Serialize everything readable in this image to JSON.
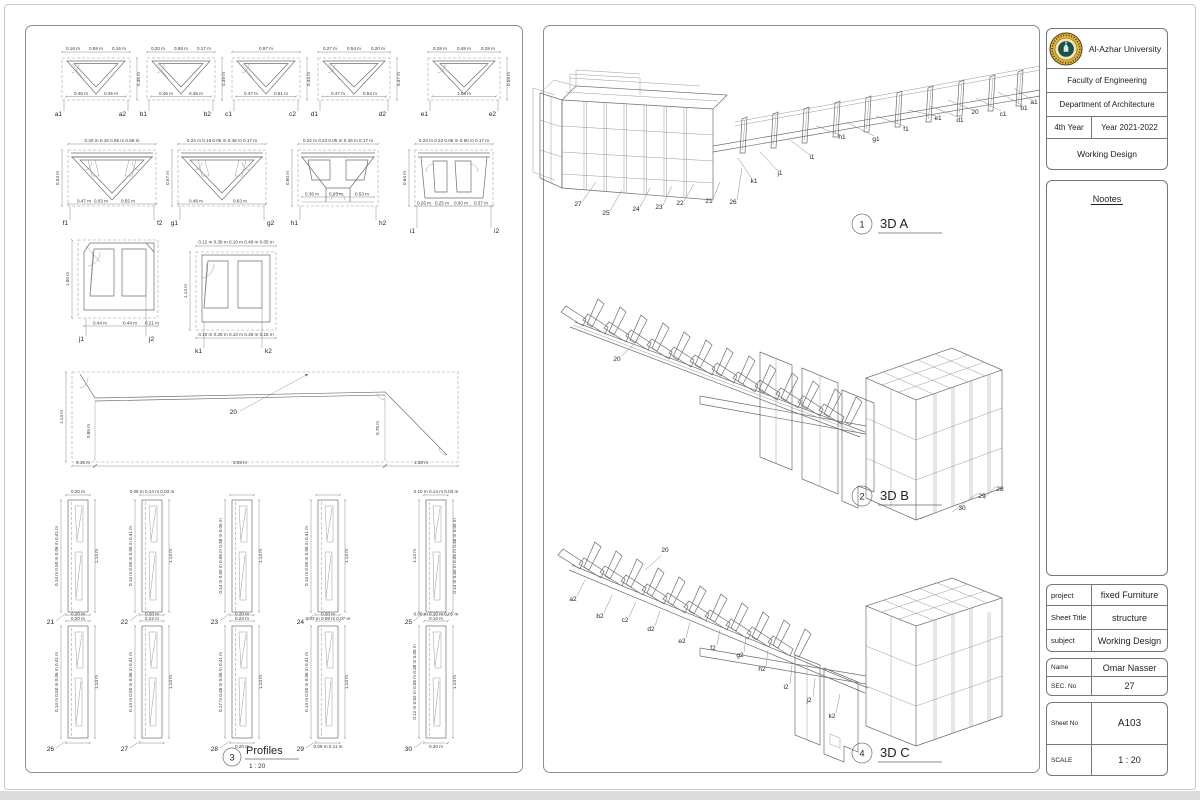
{
  "title_block": {
    "university": "Al-Azhar University",
    "faculty": "Faculty of Engineering",
    "department": "Department of Architecture",
    "year_label": "4th Year",
    "year_value": "Year 2021-2022",
    "design": "Working Design",
    "notes": "Nootes"
  },
  "info": {
    "project_label": "project",
    "project": "fixed Furniture",
    "sheet_title_label": "Sheet Title",
    "sheet_title": "structure",
    "subject_label": "subject",
    "subject": "Working Design",
    "name_label": "Name",
    "name": "Omar Nasser",
    "sec_label": "SEC. No",
    "sec": "27",
    "sheet_no_label": "Sheet No",
    "sheet_no": "A103",
    "scale_label": "SCALE",
    "scale": "1 : 20"
  },
  "views": {
    "a": {
      "num": "1",
      "title": "3D A",
      "labels": [
        "27",
        "25",
        "24",
        "23",
        "22",
        "21",
        "26",
        "k1",
        "j1",
        "i1",
        "h1",
        "g1",
        "f1",
        "e1",
        "d1",
        "20",
        "c1",
        "b1",
        "a1"
      ]
    },
    "b": {
      "num": "2",
      "title": "3D B",
      "labels": [
        "20",
        "30",
        "29",
        "28"
      ]
    },
    "c": {
      "num": "4",
      "title": "3D C",
      "labels": [
        "20",
        "a2",
        "b2",
        "c2",
        "d2",
        "e2",
        "f2",
        "g2",
        "h2",
        "i2",
        "j2",
        "k2"
      ]
    },
    "profiles": {
      "num": "3",
      "title": "Profiles",
      "scale": "1 : 20"
    }
  },
  "p": {
    "a": {
      "l": "a1",
      "r": "a2",
      "top": [
        "0.16 m",
        "0.58 m",
        "0.16 m"
      ],
      "bot": [
        "0.45 m",
        "0.45 m"
      ],
      "side": "0.35 m"
    },
    "b": {
      "l": "b1",
      "r": "b2",
      "top": [
        "0.20 m",
        "0.58 m",
        "0.17 m"
      ],
      "bot": [
        "0.46 m",
        "0.46 m"
      ],
      "side": "0.39 m"
    },
    "c": {
      "l": "c1",
      "r": "c2",
      "top": [
        "",
        "0.97 m",
        ""
      ],
      "bot": [
        "0.47 m",
        "0.51 m"
      ],
      "side": "0.43 m"
    },
    "d": {
      "l": "d1",
      "r": "d2",
      "top": [
        "0.27 m",
        "0.54 m",
        "0.20 m"
      ],
      "bot": [
        "0.47 m",
        "0.54 m"
      ],
      "side": "0.47 m"
    },
    "e": {
      "l": "e1",
      "r": "e2",
      "top": [
        "0.28 m",
        "0.48 m",
        "0.28 m"
      ],
      "bot": [
        "1.04 m",
        ""
      ],
      "side": "0.59 m"
    },
    "f": {
      "l": "f1",
      "r": "f2",
      "top": "0.20 m 0.16 0.05 m       0.66 m",
      "bot": [
        "0.47 m",
        "0.03 m",
        "0.55 m",
        ""
      ],
      "side": "0.54 m"
    },
    "g": {
      "l": "g1",
      "r": "g2",
      "top": "0.24 m 0.16 0.05 m   0.48 m   0.17 m",
      "bot": [
        "0.48 m",
        "0.63 m",
        "",
        ""
      ],
      "side": "0.57 m"
    },
    "h": {
      "l": "h1",
      "r": "h2",
      "top": "0.22 m 0.22 0.05 m   0.49 m   0.17 m",
      "bot": [
        "0.36 m",
        "0.23 m",
        "0.53 m",
        ""
      ],
      "side": "0.60 m"
    },
    "i": {
      "l": "i1",
      "r": "i2",
      "top": "0.23 m 0.22 0.06 m   0.50 m   0.17 m",
      "bot": [
        "0.26 m",
        "0.25 m",
        "0.30 m",
        "0.37 m"
      ],
      "side": "0.64 m"
    },
    "j": {
      "l": "j1",
      "r": "j2",
      "bot": [
        "0.44 m",
        "0.44 m",
        "0.21 m"
      ],
      "side": "1.00 m"
    },
    "k": {
      "l": "k1",
      "r": "k2",
      "top": "0.12 m  0.39 m  0.10 m  0.48 m  0.05 m",
      "bot": "0.10 m   0.25 m  0.10 m  0.48 m   0.15 m",
      "side": "1.14 m"
    },
    "p20": {
      "label": "20",
      "side": "1.14 m",
      "ha": "0.85 m",
      "hb": "0.78 m",
      "bot": [
        "0.18 m",
        "3.08 m",
        "1.38 m"
      ]
    },
    "slats": [
      {
        "n": "21",
        "top": "0.20 m",
        "left": "0.14 m  0.50 m  0.06 m  0.41 m",
        "right": "1.14 m",
        "bot": "0.20 m"
      },
      {
        "n": "22",
        "top": "0.05 m  0.14 m  0.03 m",
        "left": "0.14 m  0.50 m  0.06 m  0.41 m",
        "right": "1.14 m",
        "bot": "0.22 m"
      },
      {
        "n": "23",
        "top": "",
        "left": "0.14 m 0.50 m 0.06 m 0.38 m 0.05 m",
        "right": "1.14 m",
        "bot": "0.23 m"
      },
      {
        "n": "24",
        "top": "",
        "left": "0.14 m  0.50 m  0.06 m  0.41 m",
        "right": "1.14 m",
        "bot": "0.03 m 0.08 m 0.07 m"
      },
      {
        "n": "25",
        "top": "0.10 m  0.14 m  0.03 m",
        "left": "1.14 m",
        "right": "0.14 m 0.50 m 0.06 m 0.38 m 0.05 m",
        "bot": "0.10 m"
      },
      {
        "n": "26",
        "top": "0.20 m",
        "left": "0.14 m  0.50 m  0.06 m  0.41 m",
        "right": "1.14 m",
        "bot": ""
      },
      {
        "n": "27",
        "top": "0.20 m",
        "left": "0.14 m  0.50 m  0.06 m  0.41 m",
        "right": "1.14 m",
        "bot": ""
      },
      {
        "n": "28",
        "top": "0.20 m",
        "left": "0.17 m  0.46 m  0.06 m  0.41 m",
        "right": "1.14 m",
        "bot": "0.20 m"
      },
      {
        "n": "29",
        "top": "0.20 m",
        "left": "0.14 m  0.50 m  0.06 m  0.41 m",
        "right": "1.14 m",
        "bot": "0.09 m 0.11 m"
      },
      {
        "n": "30",
        "top": "0.06 m  0.10 m  0.05 m",
        "left": "0.12 m 0.52 m 0.06 m 0.38 m 0.05 m",
        "right": "1.14 m",
        "bot": "0.20 m"
      }
    ]
  },
  "colors": {
    "line": "#6e6e6e",
    "logo_gold": "#e0b43e",
    "logo_green": "#175447"
  }
}
